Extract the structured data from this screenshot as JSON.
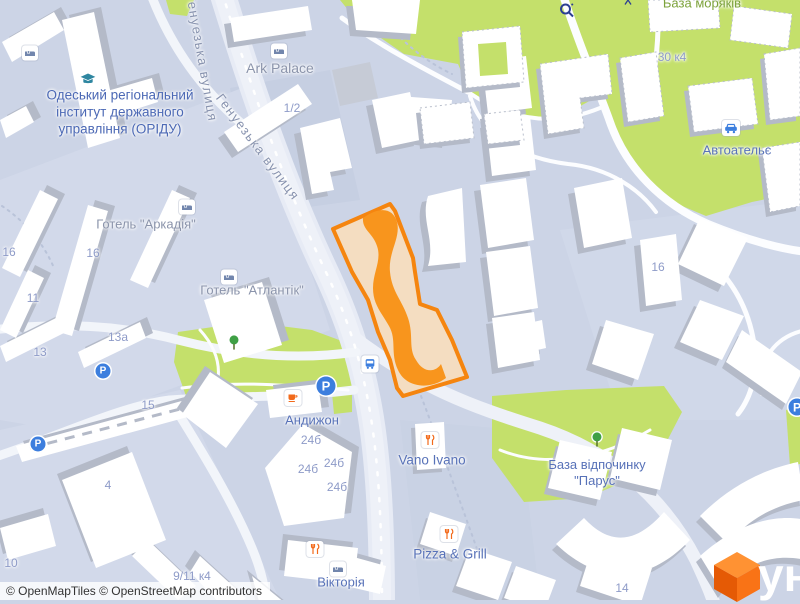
{
  "map": {
    "street_labels": [
      {
        "text": "Генуезька вулиця"
      },
      {
        "text": "Генуезька вулиця"
      }
    ],
    "poi": {
      "institute_line1": "Одеський регіональний",
      "institute_line2": "інститут державного",
      "institute_line3": "управління (ОРІДУ)",
      "ark_palace": "Ark Palace",
      "hotel_arkadia": "Готель \"Аркадія\"",
      "hotel_atlantik": "Готель \"Атлантік\"",
      "andyzhon": "Андижон",
      "vano_ivano": "Vano Ivano",
      "pizza_grill": "Pizza & Grill",
      "viktoria": "Вікторія",
      "parus_line1": "База відпочинку",
      "parus_line2": "\"Парус\"",
      "avtoatelie": "Автоательє",
      "baza_moriakiv": "База моряків"
    },
    "house_numbers": [
      {
        "text": "1/2"
      },
      {
        "text": "16"
      },
      {
        "text": "16"
      },
      {
        "text": "11"
      },
      {
        "text": "13"
      },
      {
        "text": "13а"
      },
      {
        "text": "15"
      },
      {
        "text": "10"
      },
      {
        "text": "9/11 к4"
      },
      {
        "text": "4"
      },
      {
        "text": "24б"
      },
      {
        "text": "24б"
      },
      {
        "text": "24б"
      },
      {
        "text": "24б"
      },
      {
        "text": "30 к4"
      },
      {
        "text": "16"
      },
      {
        "text": "14"
      }
    ],
    "icons": {
      "parking_letter": "P"
    }
  },
  "selection": {
    "color": "#F5850F",
    "fill": "#F4DDC1"
  },
  "colors": {
    "background": "#CCD4E6",
    "green": "#C4E06B",
    "building": "#FFFFFF",
    "building_shadow": "#B4BAC8"
  },
  "attribution": {
    "text": "© OpenMapTiles © OpenStreetMap contributors"
  },
  "logo": {
    "text": "ун"
  }
}
